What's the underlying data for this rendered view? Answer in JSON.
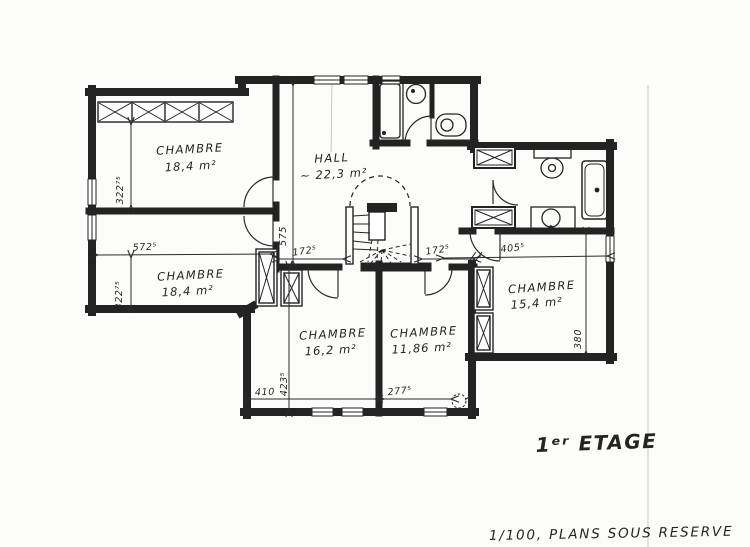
{
  "plan": {
    "floor_label": "1ᵉʳ ETAGE",
    "note": "1/100, PLANS SOUS RESERVE",
    "rooms": [
      {
        "id": "chambre-nw",
        "name": "CHAMBRE",
        "area": "18,4 m²"
      },
      {
        "id": "chambre-w",
        "name": "CHAMBRE",
        "area": "18,4 m²"
      },
      {
        "id": "hall",
        "name": "HALL",
        "area": "~ 22,3 m²"
      },
      {
        "id": "chambre-s1",
        "name": "CHAMBRE",
        "area": "16,2 m²"
      },
      {
        "id": "chambre-s2",
        "name": "CHAMBRE",
        "area": "11,86 m²"
      },
      {
        "id": "chambre-e",
        "name": "CHAMBRE",
        "area": "15,4 m²"
      }
    ],
    "dimensions": {
      "nw_height": "322⁷⁵",
      "w_width": "572⁵",
      "w_height": "322⁷⁵",
      "hall_height": "575",
      "stair_left": "172⁵",
      "stair_right": "172⁵",
      "s1_width": "410",
      "s1_height": "423⁵",
      "s2_width": "277⁵",
      "e_width": "405⁵",
      "e_height": "380"
    },
    "colors": {
      "ink": "#232323",
      "paper": "#fcfcfa",
      "fold_line": "#c6c6c2"
    }
  }
}
